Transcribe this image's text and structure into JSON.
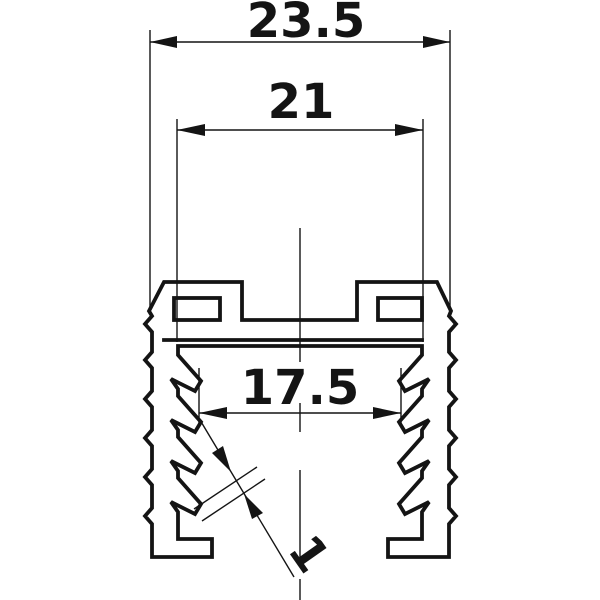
{
  "drawing": {
    "background_color": "#ffffff",
    "stroke_color": "#141414",
    "dimensions": [
      {
        "name": "overall-width",
        "value": "23.5"
      },
      {
        "name": "slot-span",
        "value": "21"
      },
      {
        "name": "channel-width",
        "value": "17.5"
      },
      {
        "name": "wall-thickness",
        "value": "1"
      }
    ]
  }
}
